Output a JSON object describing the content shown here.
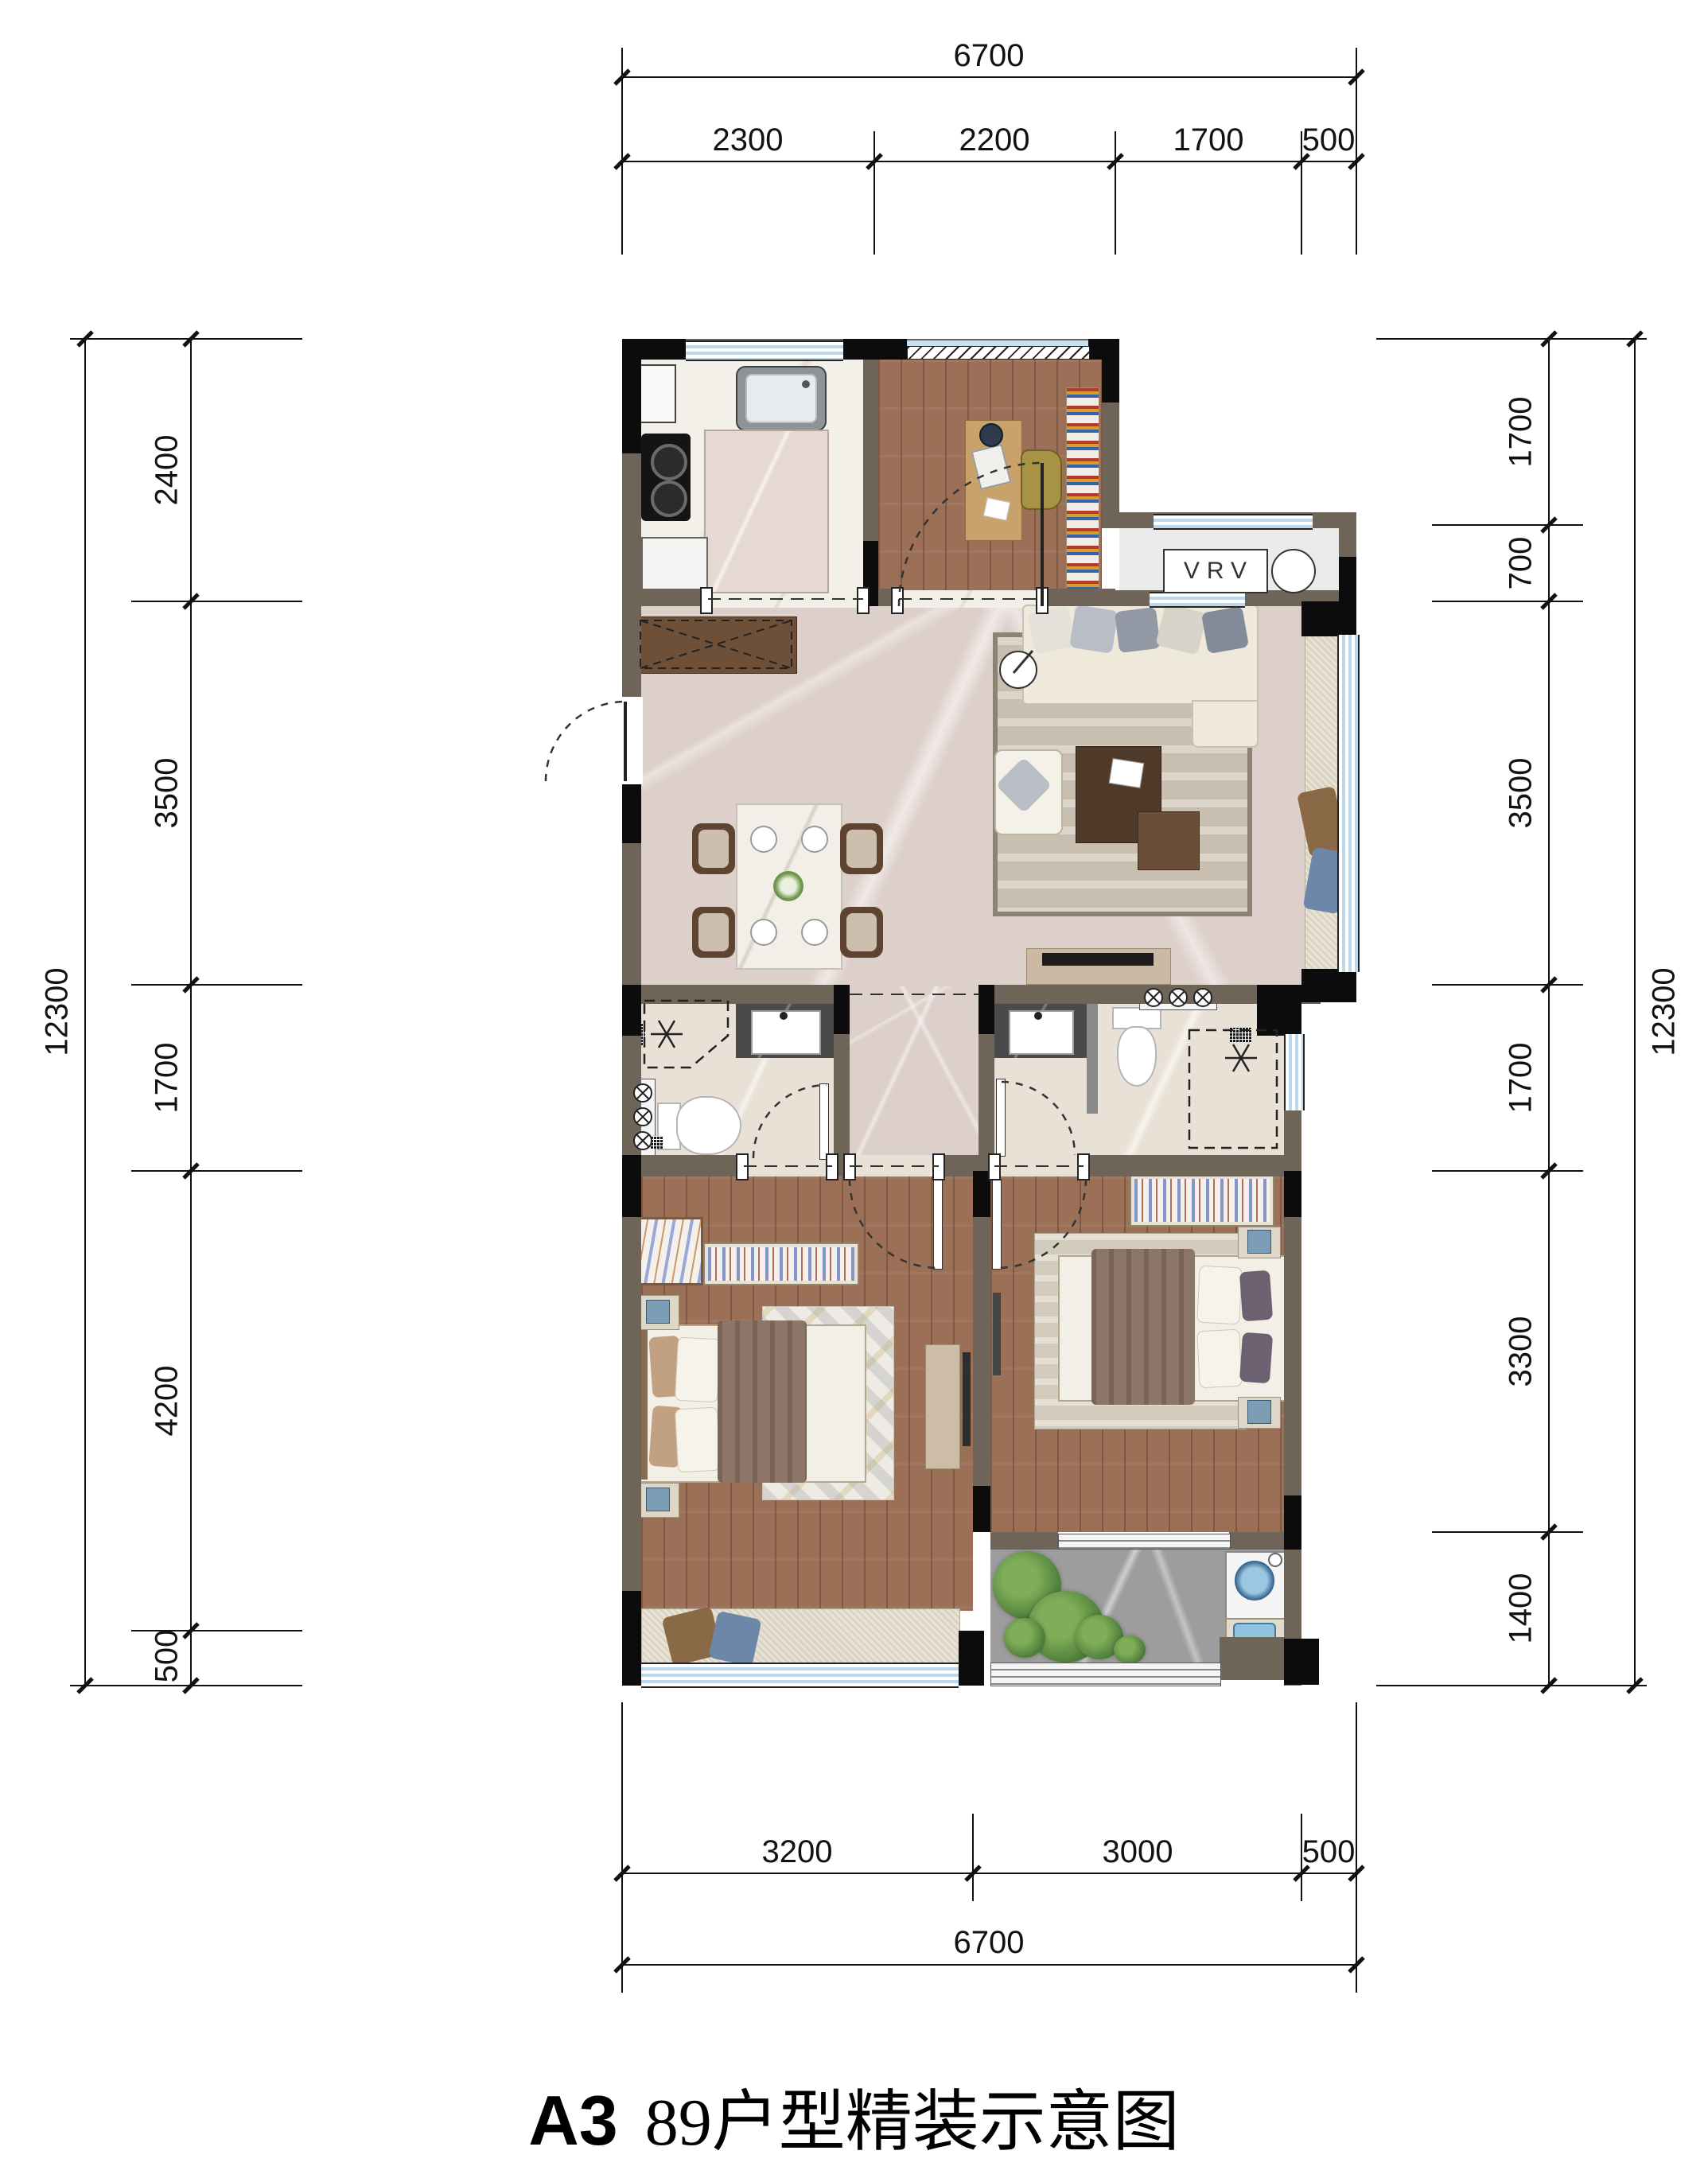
{
  "title": {
    "code": "A3",
    "name": "89户型精装示意图"
  },
  "plan": {
    "vrv_label": "VRV"
  },
  "dims": {
    "top": {
      "total": "6700",
      "segments": [
        "2300",
        "2200",
        "1700",
        "500"
      ]
    },
    "bottom": {
      "total": "6700",
      "segments": [
        "3200",
        "3000",
        "500"
      ]
    },
    "left": {
      "total": "12300",
      "segments": [
        "2400",
        "3500",
        "1700",
        "4200",
        "500"
      ]
    },
    "right": {
      "total": "12300",
      "segments": [
        "1700",
        "700",
        "3500",
        "1700",
        "3300",
        "1400"
      ]
    }
  },
  "colors": {
    "wall_infill": "#6e6458",
    "wall_structural": "#0c0c0c",
    "window_glass": "#bcd8ea",
    "wood_floor": "#9b7057",
    "marble_floor": "#ddcfc9",
    "bath_tile": "#e9e1d6",
    "balcony_stone": "#9d9d9d",
    "bedding": "#8d7567",
    "dimension_text": "#111111"
  }
}
